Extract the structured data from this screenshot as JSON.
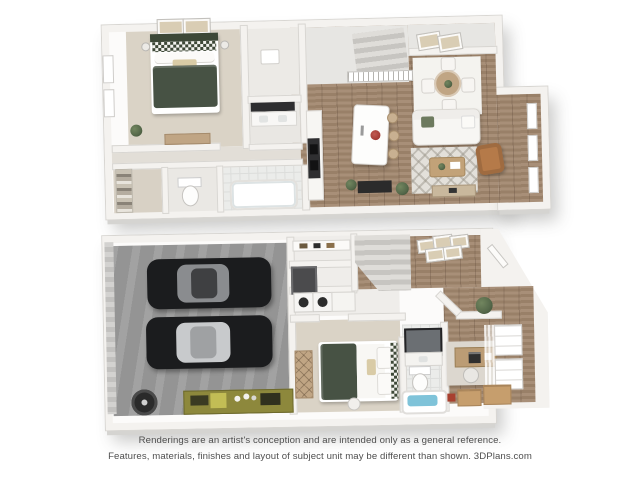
{
  "footer": {
    "line1": "Renderings are an artist's conception and are intended only as a general reference.",
    "line2": "Features, materials, finishes and layout of subject unit may be different than shown. 3DPlans.com"
  },
  "colors": {
    "background": "#ffffff",
    "wall_top": "#f4f2ef",
    "wall_edge": "#d8d6d2",
    "roof_gray": "#e7e6e3",
    "wood_floor": "#a1876e",
    "carpet": "#dad3c6",
    "tile": "#ebecea",
    "hall_floor": "#e2ded7",
    "garage_floor": "#9c9c9c",
    "bed_green": "#475244",
    "bed_green_dark": "#3d4837",
    "car_body": "#1b1c1e",
    "car_glass_dark": "#8a8c8f",
    "car_glass_light": "#c8cacc",
    "tub_water": "#7fc3d9",
    "workbench_olive": "#8d883c",
    "workbench_yellow": "#c2bd55",
    "armchair_tan": "#b57a49",
    "wood_furniture": "#c0a584",
    "box_cardboard": "#c69e6d",
    "flower_red": "#a23a34",
    "plant_green": "#55684a",
    "appliance_dark": "#2f2f31",
    "footer_text": "#4e4e4e"
  }
}
